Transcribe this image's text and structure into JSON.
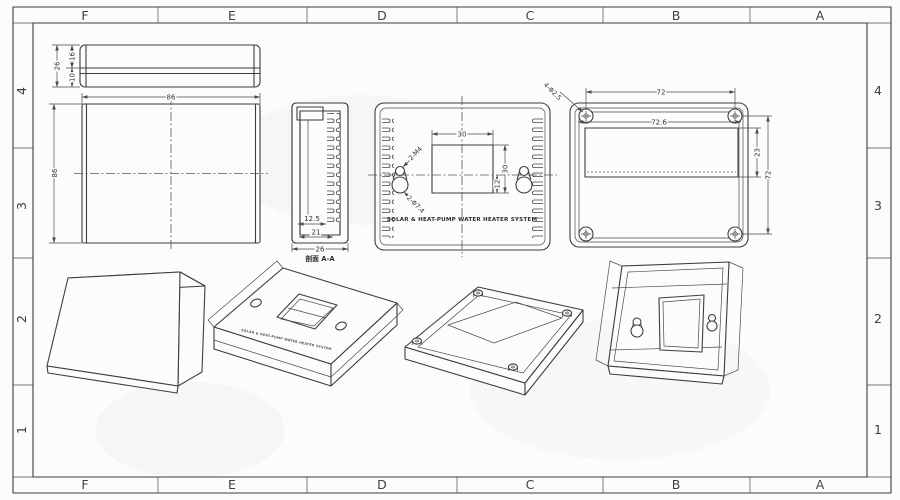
{
  "drawing": {
    "grid": {
      "columns": [
        "F",
        "E",
        "D",
        "C",
        "B",
        "A"
      ],
      "rows": [
        "4",
        "3",
        "2",
        "1"
      ]
    },
    "views": {
      "strip": {
        "h_total": "26",
        "h_upper": "16",
        "h_lower": "10"
      },
      "front": {
        "width": "86",
        "height": "86"
      },
      "section": {
        "caption": "剖面 A-A",
        "d1": "12.5",
        "d2": "21",
        "d3": "26"
      },
      "back": {
        "win_w": "30",
        "win_h": "30",
        "off": "12",
        "m4": "2-M4",
        "d74": "2-Φ7.4",
        "label": "SOLAR & HEAT-PUMP WATER HEATER SYSTEM"
      },
      "base": {
        "span_h": "72",
        "inner_w": "72.6",
        "holes": "4-Φ2.5",
        "win_h": "23",
        "span_v": "72"
      }
    },
    "colors": {
      "line": "#3d3d3d",
      "background": "#fcfcfb",
      "wall_shade": "#dddddd"
    }
  }
}
